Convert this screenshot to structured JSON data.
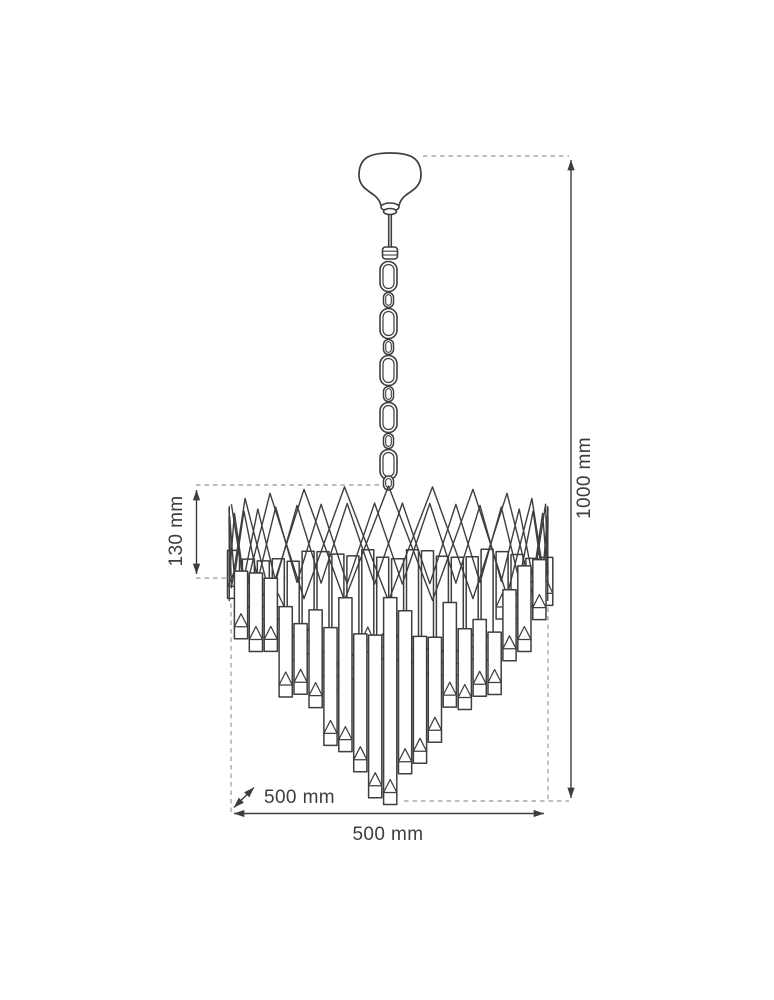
{
  "figure": {
    "alt": "technical line drawing of a crystal cascade chandelier with dimension lines"
  },
  "dimensions": {
    "overall_height": "1000 mm",
    "shade_height": "130 mm",
    "width": "500 mm",
    "depth": "500 mm"
  },
  "colors": {
    "line": "#3e3e3e",
    "dimension_line": "#3d3d3d",
    "dashed_line": "#a9a9a9",
    "background": "#ffffff",
    "text": "#3d3d3d"
  }
}
